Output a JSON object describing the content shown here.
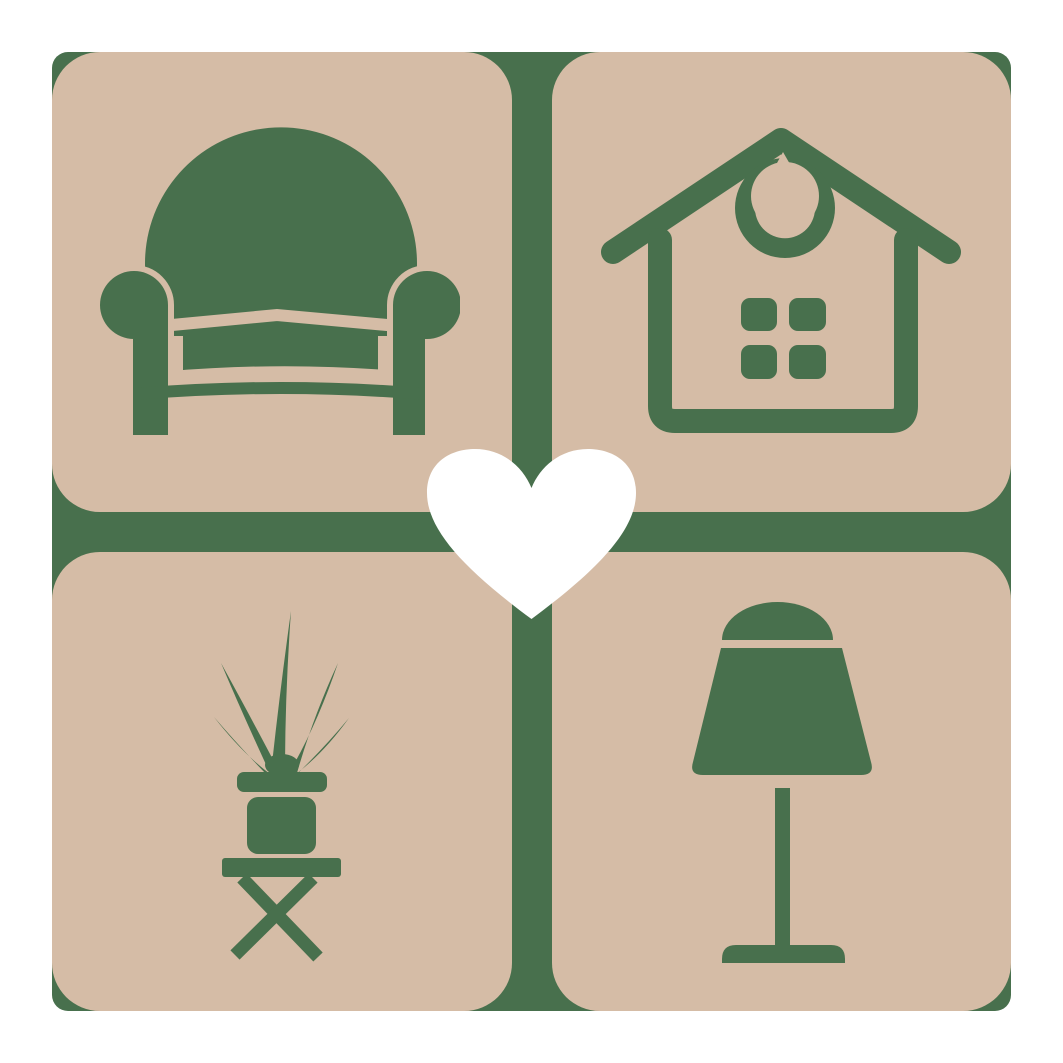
{
  "colors": {
    "background": "#ffffff",
    "tile": "#d5bca6",
    "icon_green": "#48704d",
    "heart": "#ffffff"
  },
  "logo": {
    "tiles": [
      {
        "position": "top-left",
        "icon": "armchair"
      },
      {
        "position": "top-right",
        "icon": "house"
      },
      {
        "position": "bottom-left",
        "icon": "potted plant on stool"
      },
      {
        "position": "bottom-right",
        "icon": "table lamp"
      }
    ],
    "center_icon": "heart",
    "divider": "green cross gap"
  }
}
